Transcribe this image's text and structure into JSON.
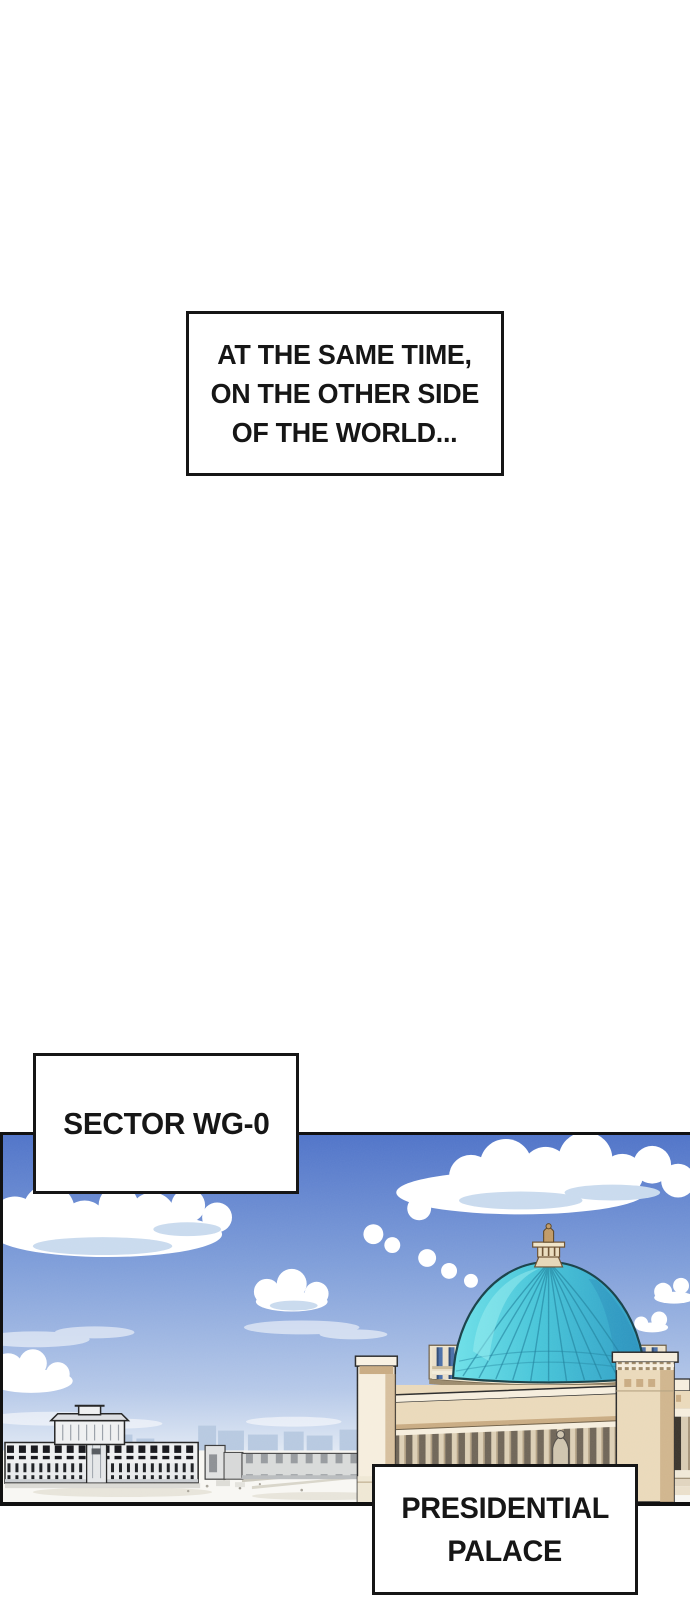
{
  "captions": {
    "time": {
      "lines": [
        "AT THE SAME TIME,",
        "ON THE OTHER SIDE",
        "OF THE WORLD..."
      ]
    },
    "sector": {
      "lines": [
        "SECTOR WG-0"
      ]
    },
    "palace": {
      "lines": [
        "PRESIDENTIAL",
        "PALACE"
      ]
    }
  },
  "colors": {
    "page_bg": "#ffffff",
    "ink": "#161616",
    "box_bg": "#ffffff",
    "sky_top": "#4f73c8",
    "sky_mid": "#7f9ed9",
    "sky_horizon": "#e8eef6",
    "cloud": "#ffffff",
    "cloud_shadow": "#c9daee",
    "skyline": "#b7c9e0",
    "dome_light": "#6ee0e8",
    "dome_mid": "#46c4d8",
    "dome_dark": "#2f9cc4",
    "dome_outline": "#173f4b",
    "stone_light": "#f6eedd",
    "stone_mid": "#ead9ba",
    "stone_shadow": "#c9ab82",
    "stone_deep": "#8a7254",
    "column_gap": "#6f6557",
    "window_blue": "#4a6fa8",
    "distant_white": "#eff0f1",
    "distant_gray": "#c9ccd0",
    "ground": "#f8f7f3",
    "ground_shade": "#e7e4da"
  }
}
